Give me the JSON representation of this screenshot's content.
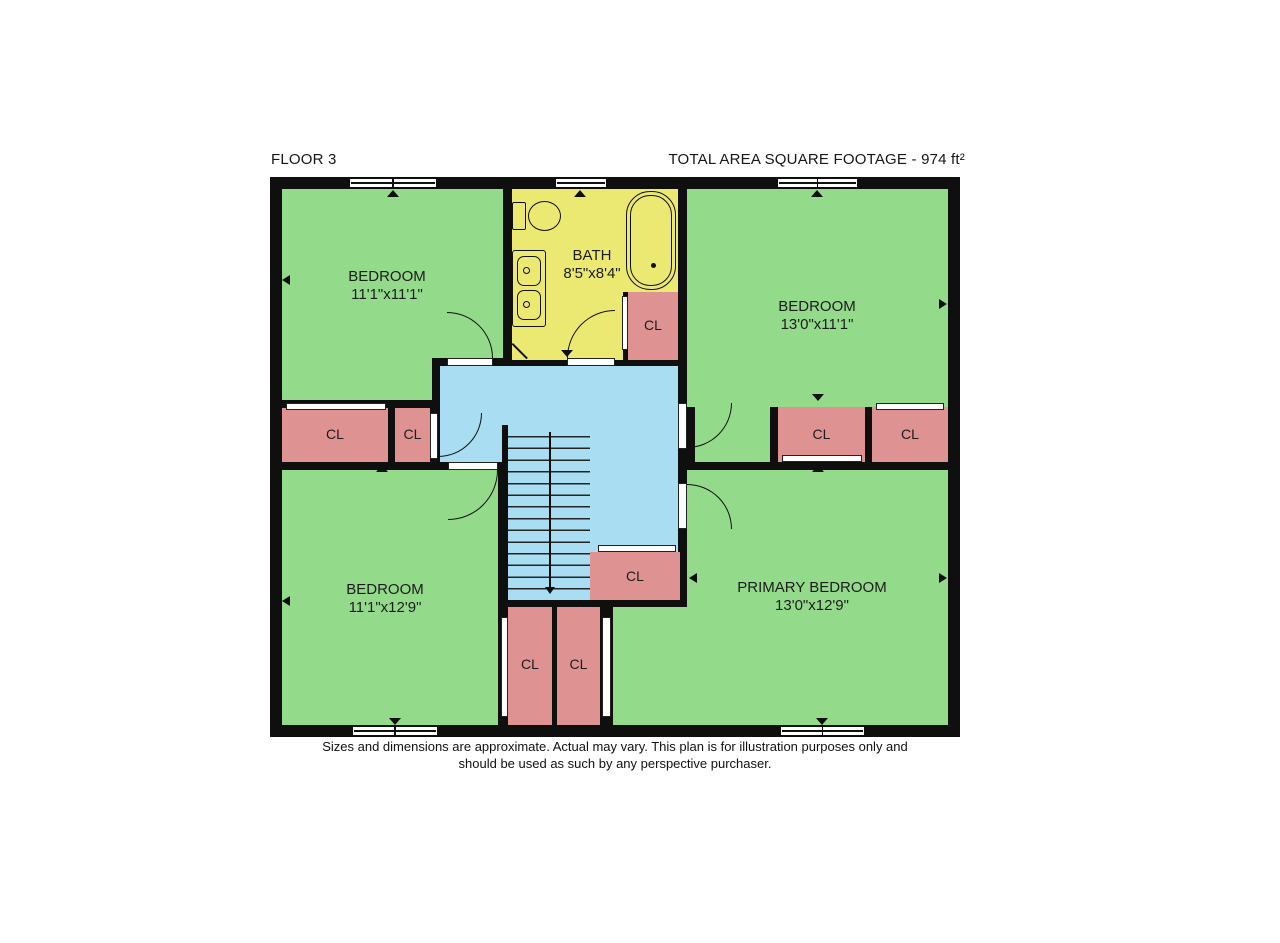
{
  "header": {
    "floor_label": "FLOOR 3",
    "area_label": "TOTAL AREA SQUARE FOOTAGE - 974 ft²"
  },
  "rooms": {
    "bedroom_top_left": {
      "name": "BEDROOM",
      "dims": "11'1\"x11'1\""
    },
    "bath": {
      "name": "BATH",
      "dims": "8'5\"x8'4\""
    },
    "bedroom_top_right": {
      "name": "BEDROOM",
      "dims": "13'0\"x11'1\""
    },
    "bedroom_bottom_left": {
      "name": "BEDROOM",
      "dims": "11'1\"x12'9\""
    },
    "primary_bedroom": {
      "name": "PRIMARY BEDROOM",
      "dims": "13'0\"x12'9\""
    }
  },
  "closet_label": "CL",
  "footer": {
    "disclaimer_line1": "Sizes and dimensions are approximate. Actual may vary. This plan is for illustration purposes only and",
    "disclaimer_line2": "should be used as such by any perspective purchaser."
  },
  "colors": {
    "bedroom_fill": "#93da8b",
    "bath_fill": "#ece973",
    "hall_fill": "#a9def2",
    "closet_fill": "#df9292",
    "wall": "#0f0f0f",
    "fixture_line": "#111111",
    "label_text": "#1c1c1c",
    "background": "#ffffff"
  }
}
